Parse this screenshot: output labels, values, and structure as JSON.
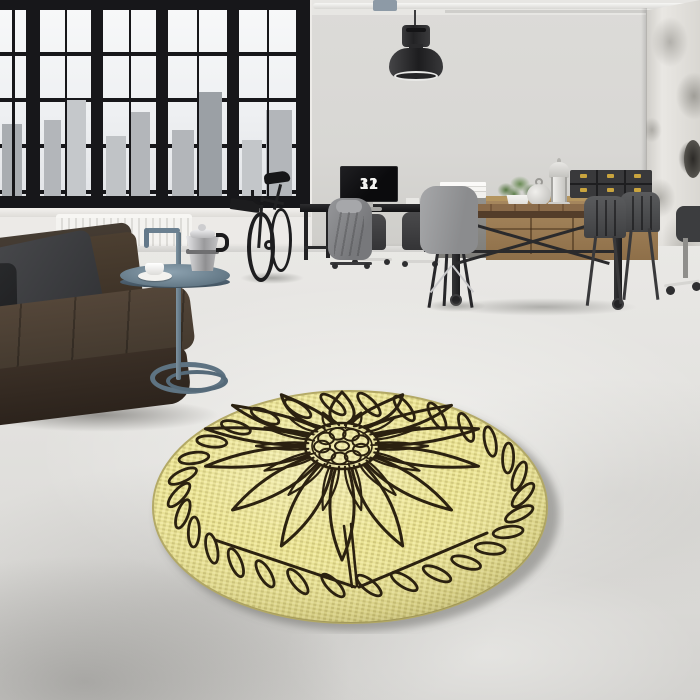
{
  "scene": {
    "label": "Industrial loft living room with a round yellow floral area rug",
    "monitor_clock": {
      "hours": "11",
      "minutes": "32"
    }
  },
  "rug": {
    "description": "Round yellow rug with black-outlined sunflower medallion and braided rope border",
    "background_color": "#e9e293",
    "weave_dot_color": "#c9bf74",
    "weave_light_color": "#f5efab",
    "outline_color": "#2b2110",
    "binding_color": "#b3a965",
    "outer_petal_count": 14,
    "inner_petal_count": 14,
    "center_circle_count": 9,
    "braid_link_count": 30
  },
  "palette": {
    "wall": "#d9d8d5",
    "floor": "#e2e1de",
    "window_frame": "#17171a",
    "sofa_leather": "#443a30",
    "pillow_gray": "#3d3e41",
    "side_table_metal": "#64798a",
    "wood_furniture": "#96764f",
    "lamp_black": "#2c2c2e",
    "box_brass": "#c9a43e",
    "plant_green": "#5d7f4a",
    "monitor_digits": "#f4f4f2"
  }
}
